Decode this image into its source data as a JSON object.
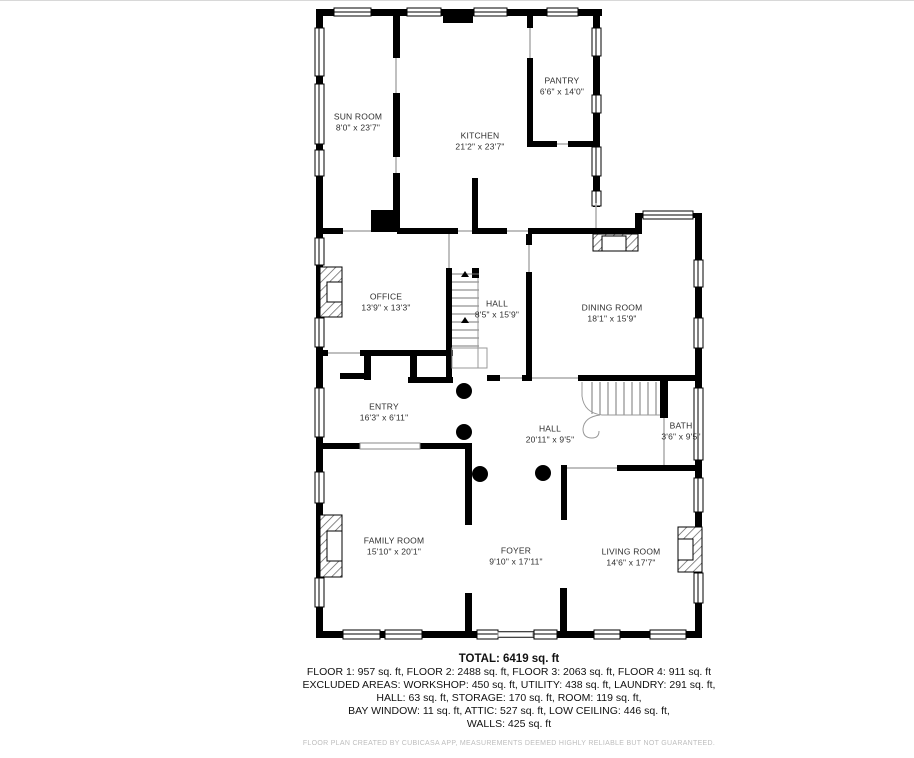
{
  "page": {
    "background": "#ffffff",
    "edge_line_color": "#d8d8d8"
  },
  "colors": {
    "wall": "#000000",
    "thin_line": "#aaaaaa",
    "stair_line": "#777777",
    "label_text": "#2e2e2e",
    "footer_text": "#bdbdbd"
  },
  "rooms": [
    {
      "name": "SUN ROOM",
      "dims": "8'0\" x 23'7\""
    },
    {
      "name": "KITCHEN",
      "dims": "21'2\" x 23'7\""
    },
    {
      "name": "PANTRY",
      "dims": "6'6\" x 14'0\""
    },
    {
      "name": "OFFICE",
      "dims": "13'9\" x 13'3\""
    },
    {
      "name": "HALL",
      "dims": "8'5\" x 15'9\""
    },
    {
      "name": "DINING ROOM",
      "dims": "18'1\" x 15'9\""
    },
    {
      "name": "ENTRY",
      "dims": "16'3\" x 6'11\""
    },
    {
      "name": "HALL",
      "dims": "20'11\" x 9'5\""
    },
    {
      "name": "BATH",
      "dims": "3'6\" x 9'5\""
    },
    {
      "name": "FAMILY ROOM",
      "dims": "15'10\" x 20'1\""
    },
    {
      "name": "FOYER",
      "dims": "9'10\" x 17'11\""
    },
    {
      "name": "LIVING ROOM",
      "dims": "14'6\" x 17'7\""
    }
  ],
  "summary": {
    "total": "TOTAL: 6419 sq. ft",
    "lines": [
      "FLOOR 1: 957 sq. ft, FLOOR 2: 2488 sq. ft, FLOOR 3: 2063 sq. ft, FLOOR 4: 911 sq. ft",
      "EXCLUDED AREAS: WORKSHOP: 450 sq. ft, UTILITY: 438 sq. ft, LAUNDRY: 291 sq. ft,",
      "HALL: 63 sq. ft, STORAGE: 170 sq. ft, ROOM: 119 sq. ft,",
      "BAY WINDOW: 11 sq. ft, ATTIC: 527 sq. ft, LOW CEILING: 446 sq. ft,",
      "WALLS: 425 sq. ft"
    ]
  },
  "footer": "FLOOR PLAN CREATED BY CUBICASA APP, MEASUREMENTS DEEMED HIGHLY RELIABLE BUT NOT GUARANTEED."
}
